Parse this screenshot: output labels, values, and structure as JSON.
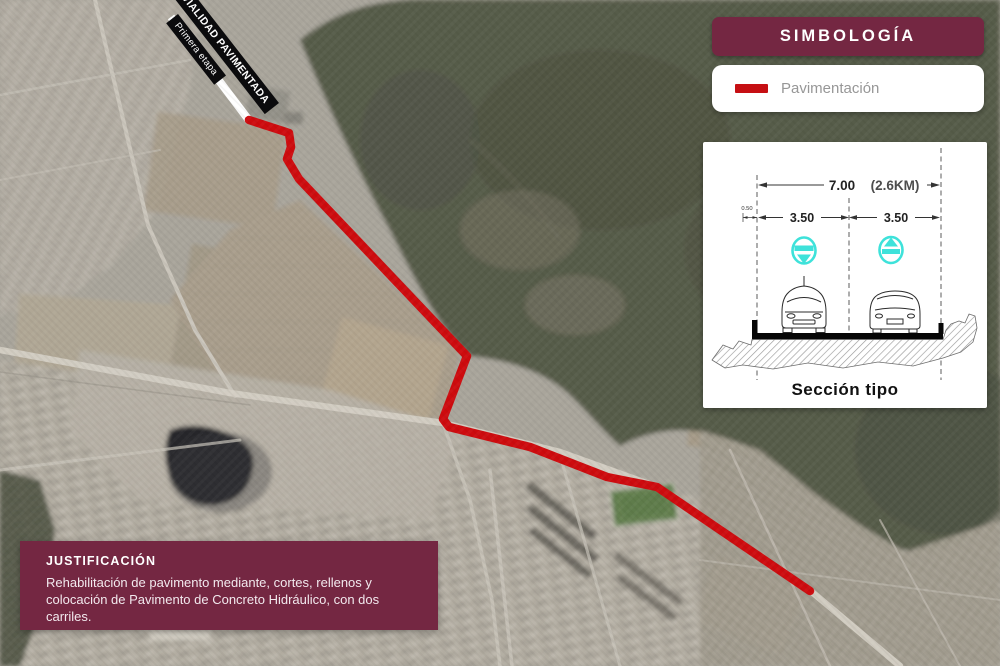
{
  "map": {
    "route_banner": {
      "title": "VIALIDAD PAVIMENTADA",
      "subtitle": "Primera etapa"
    }
  },
  "legend": {
    "title": "SIMBOLOGÍA",
    "items": [
      {
        "label": "Pavimentación",
        "color": "#c60f13"
      }
    ]
  },
  "section": {
    "caption": "Sección tipo",
    "total_width_label": "7.00",
    "length_label": "(2.6KM)",
    "lane_left_label": "3.50",
    "lane_right_label": "3.50",
    "shoulder_label": "0.50"
  },
  "justification": {
    "title": "JUSTIFICACIÓN",
    "body": "Rehabilitación de pavimento mediante, cortes, rellenos y colocación de Pavimento de Concreto Hidráulico, con dos carriles."
  },
  "colors": {
    "maroon": "#742742",
    "route_red": "#ce0b0e",
    "lane_symbol_cyan": "#3ee2da"
  }
}
